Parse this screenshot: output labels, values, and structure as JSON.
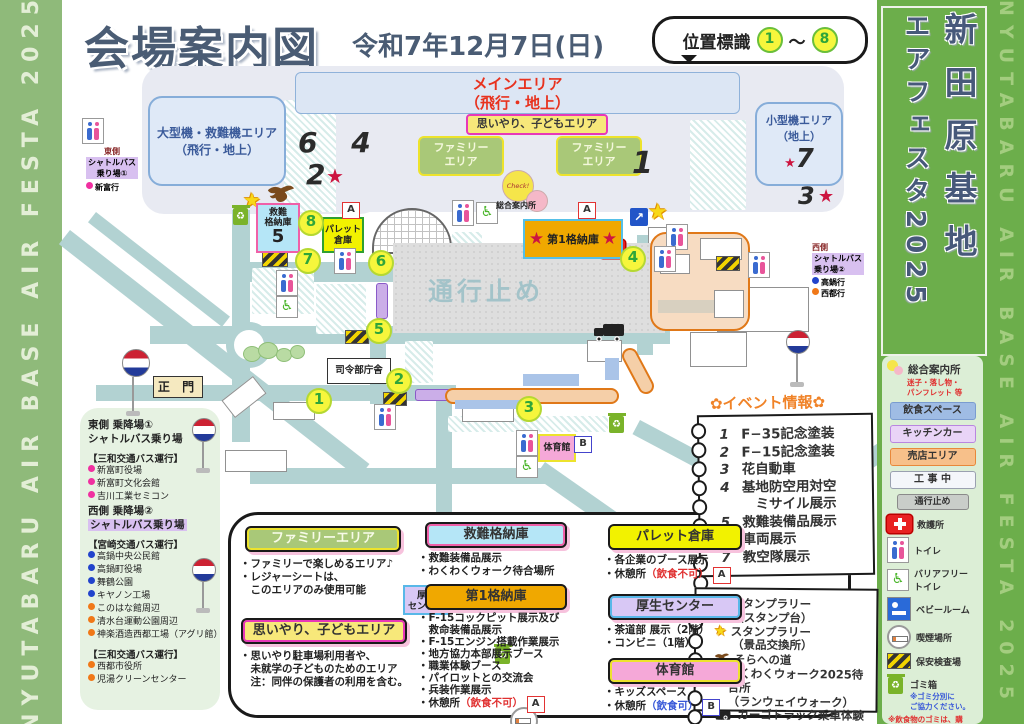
{
  "edges": {
    "left_text": "NYUTABARU AIR BASE AIR FESTA 2025",
    "right_text": "NYUTABARU AIR BASE AIR FESTA 2025"
  },
  "banner": {
    "line1": "新田原基地",
    "line2": "エアフェスタ2025"
  },
  "header": {
    "title": "会場案内図",
    "date": "令和7年12月7日(日)",
    "bubble_label": "位置標識",
    "bubble_start": "1",
    "bubble_tilde": "～",
    "bubble_end": "8"
  },
  "map": {
    "markers": [
      "1",
      "2",
      "3",
      "4",
      "5",
      "6",
      "7",
      "8"
    ],
    "main_area_l1": "メインエリア",
    "main_area_l2": "（飛行・地上）",
    "large_area_l1": "大型機・救難機エリア",
    "large_area_l2": "（飛行・地上）",
    "small_area_l1": "小型機エリア",
    "small_area_l2": "（地上）",
    "family_l1": "ファミリー",
    "family_l2": "エリア",
    "omoiyari": "思いやり、子どもエリア",
    "rescue_l1": "救難",
    "rescue_l2": "格納庫",
    "rescue_num": "5",
    "pallet_l1": "パレット",
    "pallet_l2": "倉庫",
    "hangar1": "第1格納庫",
    "kousei_l1": "厚生",
    "kousei_l2": "センター",
    "gym": "体育館",
    "main_gate": "正 門",
    "hq": "司令部庁舎",
    "road_closed": "通行止め",
    "check": "Check!",
    "info_office": "総合案内所",
    "n64": "6 4",
    "n2": "2",
    "n1": "1",
    "n7": "7",
    "n3": "3",
    "badge_a": "A",
    "badge_b": "B",
    "star": "★",
    "arrow": "↗",
    "east_l1": "東側",
    "east_l2": "シャトルバス",
    "east_l3": "乗り場①",
    "east_dest": "新富行",
    "west_l1": "西側",
    "west_l2": "シャトルバス",
    "west_l3": "乗り場②",
    "west_dest1": "高鍋行",
    "west_dest2": "西都行"
  },
  "bus_panel": {
    "east_title1": "東側 乗降場①",
    "east_title2": "シャトルバス乗り場",
    "east_operator": "【三和交通バス運行】",
    "east_stops": [
      "新富町役場",
      "新富町文化会館",
      "吉川工業セミコン"
    ],
    "west_title1": "西側 乗降場②",
    "west_title2": "シャトルバス乗り場",
    "west_operator1": "【宮崎交通バス運行】",
    "west_stops_blue": [
      "高鍋中央公民館",
      "高鍋町役場",
      "舞鶴公園",
      "キヤノン工場"
    ],
    "west_stops_orange": [
      "このはな館周辺",
      "清水台運動公園周辺",
      "神楽酒造西都工場（アグリ館）"
    ],
    "west_operator2": "【三和交通バス運行】",
    "west_stops2": [
      "西都市役所",
      "児湯クリーンセンター"
    ]
  },
  "legend": {
    "family": {
      "title": "ファミリーエリア",
      "l1": "・ファミリーで楽しめるエリア♪",
      "l2": "・レジャーシートは、",
      "l3": "　このエリアのみ使用可能"
    },
    "omoiyari": {
      "title": "思いやり、子どもエリア",
      "l1": "・思いやり駐車場利用者や、",
      "l2": "　未就学の子どものためのエリア",
      "l3": "　注：同伴の保護者の利用を含む。"
    },
    "rescue": {
      "title": "救難格納庫",
      "l1": "・救難装備品展示",
      "l2": "・わくわくウォーク待合場所"
    },
    "hangar1": {
      "title": "第1格納庫",
      "l1": "・F-15コックピット展示及び",
      "l2": "　救命装備品展示",
      "l3": "・F-15エンジン搭載作業展示",
      "l4": "・地方協力本部展示ブース",
      "l5": "・職業体験ブース",
      "l6": "・パイロットとの交流会",
      "l7": "・兵装作業展示",
      "rest": "・休憩所",
      "rest_note": "（飲食不可）",
      "badge": "A"
    },
    "pallet": {
      "title": "パレット倉庫",
      "l1": "・各企業のブース展示",
      "rest": "・休憩所",
      "rest_note": "（飲食不可）",
      "badge": "A"
    },
    "kousei": {
      "title": "厚生センター",
      "l1": "・茶道部 展示（2階）",
      "l2": "・コンビニ（1階）"
    },
    "gym": {
      "title": "体育館",
      "l1": "・キッズスペース",
      "rest": "・休憩所",
      "rest_note": "（飲食可）",
      "badge": "B"
    }
  },
  "event_info": {
    "title": "✿イベント情報✿",
    "rows": [
      {
        "no": "1",
        "text": "F−35記念塗装"
      },
      {
        "no": "2",
        "text": "F−15記念塗装"
      },
      {
        "no": "3",
        "text": "花自動車"
      },
      {
        "no": "4",
        "text": "基地防空用対空"
      },
      {
        "no": "",
        "text": "　ミサイル展示"
      },
      {
        "no": "5",
        "text": "救難装備品展示"
      },
      {
        "no": "6",
        "text": "車両展示"
      },
      {
        "no": "7",
        "text": "教空隊展示"
      }
    ]
  },
  "stamp": {
    "r1": "スタンプラリー",
    "r2": "（スタンプ台）",
    "r3": "スタンプラリー",
    "r4": "（景品交換所）",
    "r5": "そらへの道",
    "r6": "わくわくウォーク2025待合所",
    "r7": "（ランウェイウォーク）",
    "r8": "カーゴトラック乗車体験"
  },
  "sidebar": {
    "info_title": "総合案内所",
    "info_note1": "迷子・落し物・",
    "info_note2": "パンフレット 等",
    "chip_food": "飲食スペース",
    "chip_kitchen": "キッチンカー",
    "chip_shop": "売店エリア",
    "chip_construction": "工 事 中",
    "chip_closed": "通行止め",
    "row_aid": "救護所",
    "row_toilet": "トイレ",
    "row_bf1": "バリアフリー",
    "row_bf2": "トイレ",
    "row_baby": "ベビールーム",
    "row_smoke": "喫煙場所",
    "row_security": "保安検査場",
    "trash_label": "ゴミ箱",
    "trash_note1": "※ゴミ分別に",
    "trash_note2": "ご協力ください。",
    "bottom1": "※飲食物のゴミは、購",
    "bottom2": "入されたお店で回収し",
    "bottom3": "ております。"
  },
  "colors": {
    "accent_green": "#6cae4b",
    "title_blue": "#4a5c74",
    "road_teal": "#b2d2d2",
    "closed_gray": "#dedede",
    "star_red": "#cc1540",
    "star_yellow": "#f8d818"
  }
}
